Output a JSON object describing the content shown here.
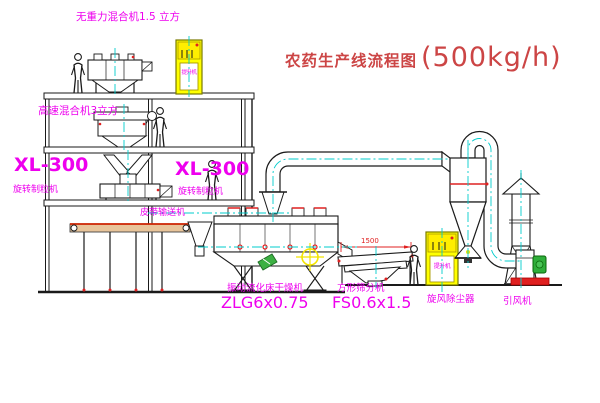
{
  "title": {
    "name_cn": "农药生产线流程图",
    "capacity": "(500kg/h)"
  },
  "equipment_labels": {
    "gravity_mixer": "无重力混合机1.5 立方",
    "high_speed_mixer": "高速混合机3立方",
    "granulator_left_model": "XL-300",
    "granulator_left_name": "旋转制粒机",
    "granulator_right_model": "XL-300",
    "granulator_right_name": "旋转制粒机",
    "belt_conveyor": "皮带输送机",
    "fluid_bed_dryer_name": "振动流化床干燥机",
    "fluid_bed_dryer_model": "ZLG6x0.75",
    "square_sieve_name": "方形筛分机",
    "square_sieve_model": "FS0.6x1.5",
    "cyclone": "旋风除尘器",
    "induced_draft_fan": "引风机",
    "bucket_elevator_1": "提升机",
    "bucket_elevator_2": "提升机"
  },
  "dimensions": {
    "sieve_width": "1500"
  },
  "colors": {
    "title_red": "#cc4545",
    "label_magenta": "#ee00ee",
    "centerline_cyan": "#00cccc",
    "elevator_yellow": "#ffff00",
    "fan_green": "#2fae3a",
    "accent_red": "#e02020",
    "belt_tan": "#e8c49a",
    "line_black": "#1a1a1a"
  }
}
